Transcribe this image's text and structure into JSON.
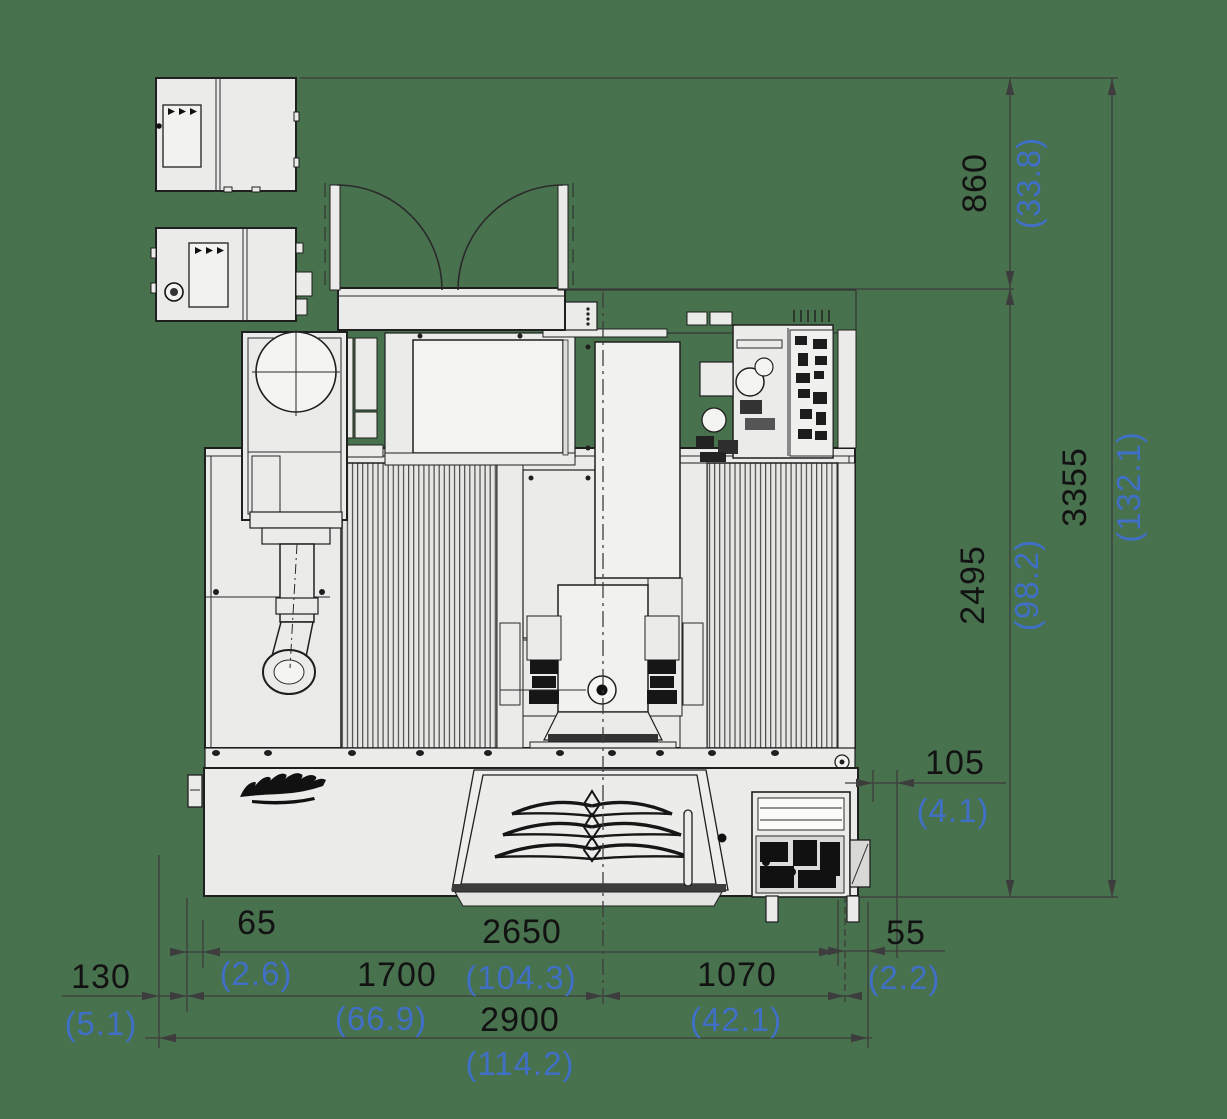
{
  "drawing": {
    "title": "machine-footprint-dimension-drawing-top-view",
    "units": {
      "primary": "mm",
      "secondary": "inch"
    },
    "colors": {
      "background": "#48714e",
      "machine_fill": "#ebebe9",
      "line": "#1f1f1f",
      "dimension_line": "#3d3d3d",
      "dimension_mm_text": "#121212",
      "dimension_inch_text": "#4070c5"
    },
    "icons": {
      "brand_logo": "script-logo",
      "emblem": "triple-wing-emblem"
    },
    "dimensions": {
      "vertical": [
        {
          "name": "door-open-depth",
          "mm": "860",
          "inch": "(33.8)"
        },
        {
          "name": "body-depth",
          "mm": "2495",
          "inch": "(98.2)"
        },
        {
          "name": "total-depth",
          "mm": "3355",
          "inch": "(132.1)"
        }
      ],
      "side": [
        {
          "name": "rear-offset",
          "mm": "105",
          "inch": "(4.1)"
        },
        {
          "name": "right-offset",
          "mm": "55",
          "inch": "(2.2)"
        }
      ],
      "bottom": [
        {
          "name": "left-outer-offset",
          "mm": "130",
          "inch": "(5.1)"
        },
        {
          "name": "left-inner-offset",
          "mm": "65",
          "inch": "(2.6)"
        },
        {
          "name": "left-width",
          "mm": "1700",
          "inch": "(66.9)"
        },
        {
          "name": "door-open-width",
          "mm": "2650",
          "inch": "(104.3)"
        },
        {
          "name": "right-width",
          "mm": "1070",
          "inch": "(42.1)"
        },
        {
          "name": "total-width",
          "mm": "2900",
          "inch": "(114.2)"
        }
      ]
    }
  }
}
